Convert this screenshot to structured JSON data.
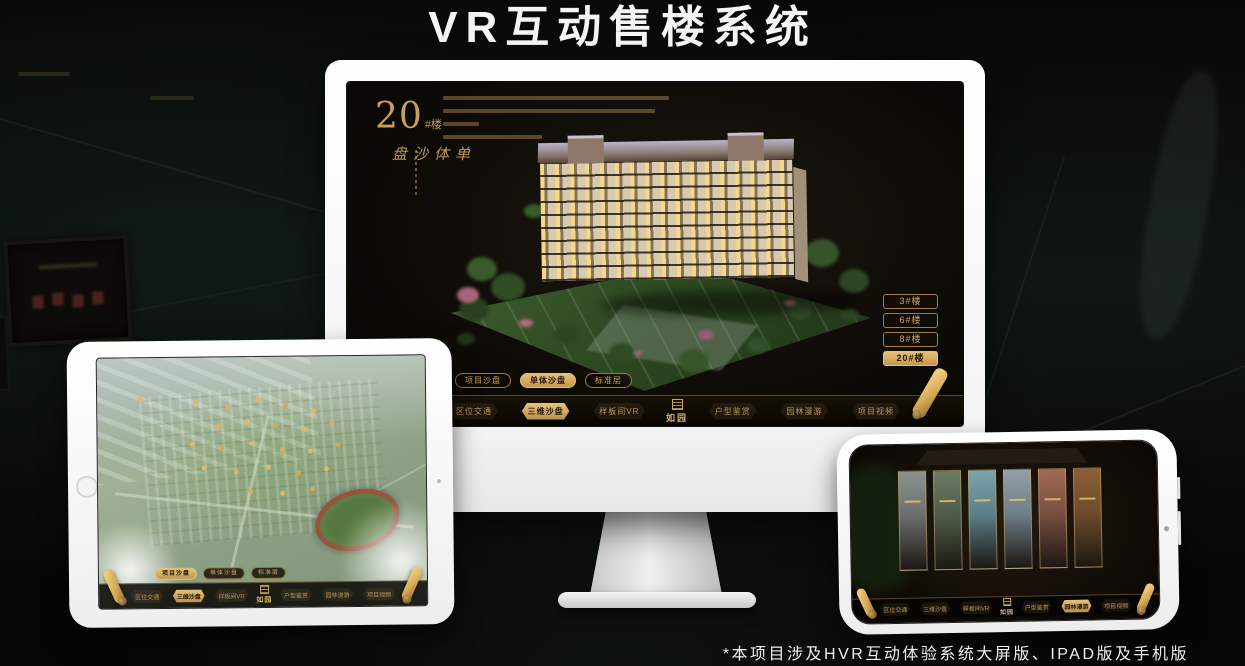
{
  "page": {
    "title": "VR互动售楼系统",
    "footnote": "*本项目涉及HVR互动体验系统大屏版、IPAD版及手机版"
  },
  "colors": {
    "gold": "#c99d5f",
    "gold_active": "#d9b26a",
    "screen_bg": "#14100a",
    "title_text": "#f4f4f4"
  },
  "monitor_app": {
    "hero_number": "20",
    "hero_suffix": "#楼",
    "hero_subtitle": "单体沙盘",
    "floor_buttons": [
      {
        "label": "3#楼",
        "active": false
      },
      {
        "label": "6#楼",
        "active": false
      },
      {
        "label": "8#楼",
        "active": false
      },
      {
        "label": "20#楼",
        "active": true
      }
    ],
    "view_tabs": [
      {
        "label": "项目沙盘",
        "active": false
      },
      {
        "label": "单体沙盘",
        "active": true
      },
      {
        "label": "标准层",
        "active": false
      }
    ],
    "nav": {
      "logo": "如园",
      "items": [
        {
          "label": "区位交通",
          "active": false
        },
        {
          "label": "三维沙盘",
          "active": true
        },
        {
          "label": "样板间VR",
          "active": false
        },
        {
          "label": "户型鉴赏",
          "active": false
        },
        {
          "label": "园林漫游",
          "active": false
        },
        {
          "label": "项目视频",
          "active": false
        }
      ]
    }
  },
  "ipad_app": {
    "view_tabs": [
      {
        "label": "项目沙盘",
        "active": true
      },
      {
        "label": "单体沙盘",
        "active": false
      },
      {
        "label": "标准层",
        "active": false
      }
    ],
    "nav": {
      "logo": "如园",
      "items": [
        {
          "label": "区位交通",
          "active": false
        },
        {
          "label": "三维沙盘",
          "active": true
        },
        {
          "label": "样板间VR",
          "active": false
        },
        {
          "label": "户型鉴赏",
          "active": false
        },
        {
          "label": "园林漫游",
          "active": false
        },
        {
          "label": "项目视频",
          "active": false
        }
      ]
    }
  },
  "phone_app": {
    "nav": {
      "logo": "如园",
      "items": [
        {
          "label": "区位交通",
          "active": false
        },
        {
          "label": "三维沙盘",
          "active": false
        },
        {
          "label": "样板间VR",
          "active": false
        },
        {
          "label": "户型鉴赏",
          "active": false
        },
        {
          "label": "园林漫游",
          "active": true
        },
        {
          "label": "项目视频",
          "active": false
        }
      ]
    }
  }
}
